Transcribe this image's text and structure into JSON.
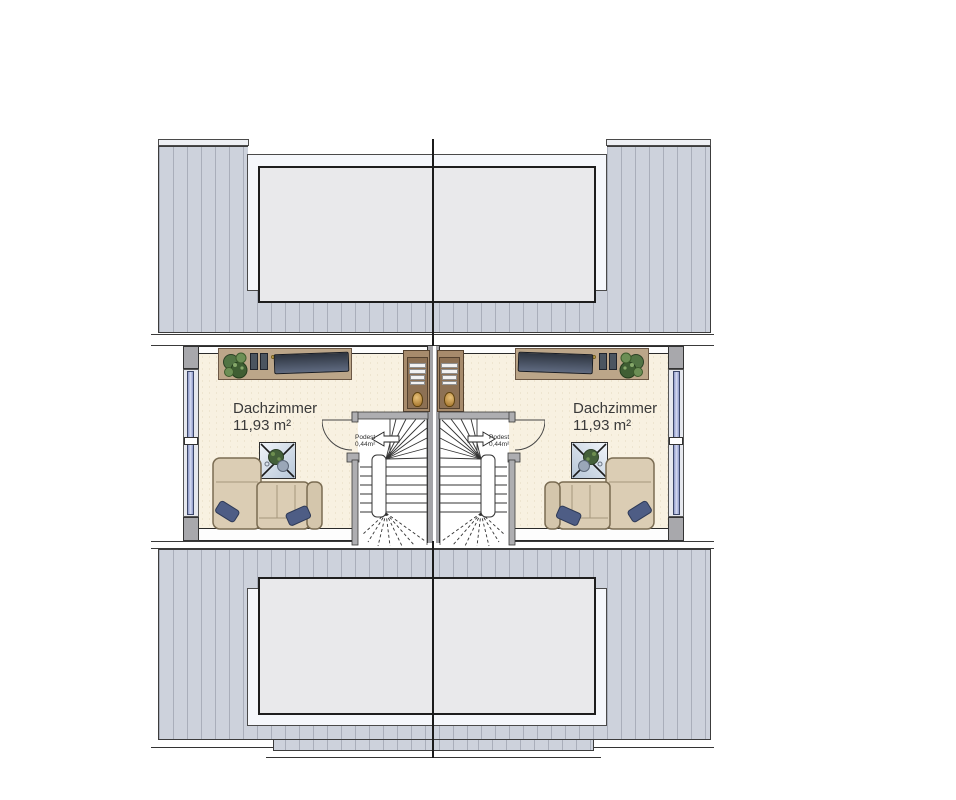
{
  "rooms": {
    "left": {
      "name": "Dachzimmer",
      "area": "11,93 m²"
    },
    "right": {
      "name": "Dachzimmer",
      "area": "11,93 m²"
    }
  },
  "stairs": {
    "left": {
      "label": "Podest",
      "area": "0,44m²"
    },
    "right": {
      "label": "Podest",
      "area": "0,44m²"
    }
  },
  "legend": {
    "icons": [
      "plant-icon",
      "tv-icon",
      "sofa",
      "coffee-table",
      "staircase",
      "door-swing",
      "direction-arrow-icon",
      "skylight-dormer",
      "window"
    ]
  },
  "colors": {
    "roof": "#cdd2dc",
    "roof_stripe": "#a9aeba",
    "dormer_glass": "#e9e9eb",
    "floor": "#f8f1e1",
    "wall": "#a8a8ac",
    "window_glass": "#8d99c9",
    "wood": "#bca689",
    "sofa": "#dbcdb4",
    "pillow": "#4e5d85",
    "line": "#1b1b1b"
  }
}
